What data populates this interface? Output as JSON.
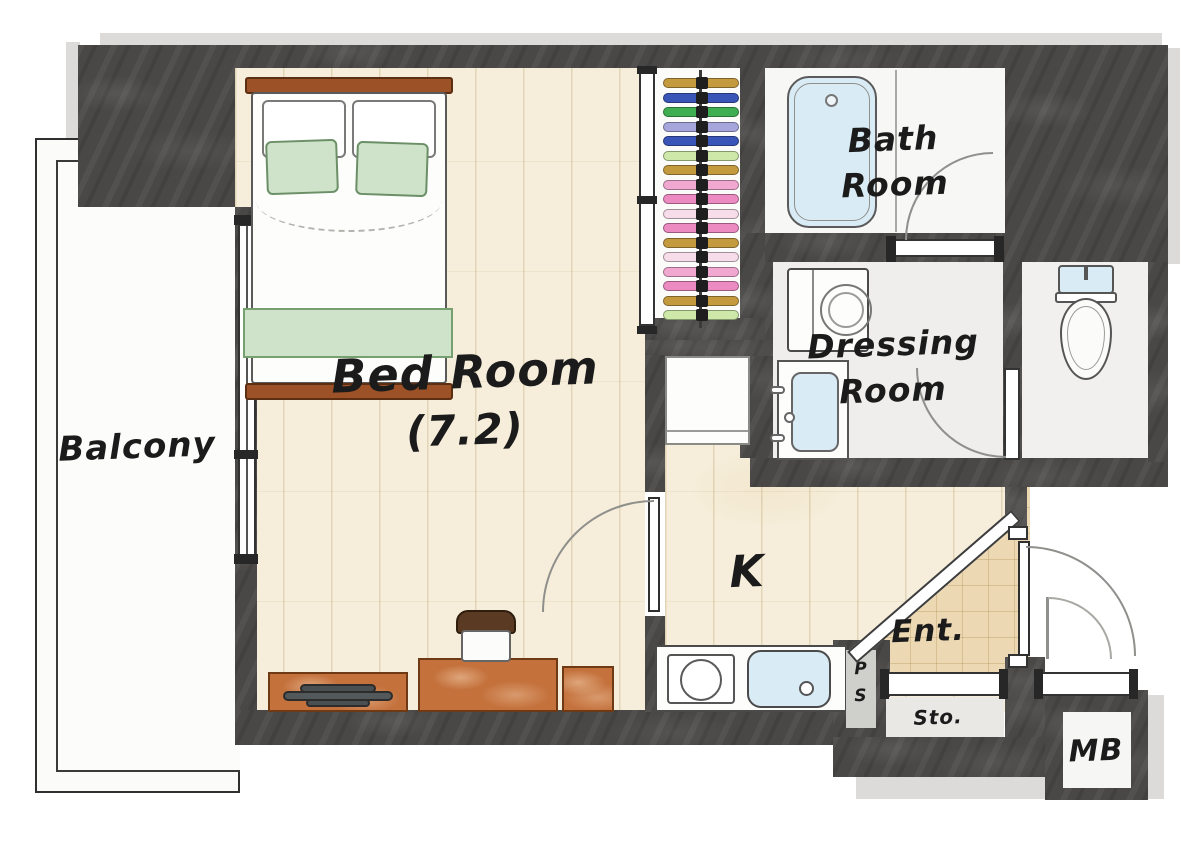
{
  "labels": {
    "balcony": "Balcony",
    "bedroom": "Bed Room",
    "bedroom_size": "(7.2)",
    "bath_line1": "Bath",
    "bath_line2": "Room",
    "dressing_line1": "Dressing",
    "dressing_line2": "Room",
    "kitchen": "K",
    "entrance": "Ent.",
    "storage": "Sto.",
    "pipe_shaft_p": "P",
    "pipe_shaft_s": "S",
    "meter_box": "MB"
  },
  "colors": {
    "wall": "#4a4846",
    "wood_floor": "#f6eedb",
    "tile_floor": "#efeeec",
    "entrance_floor": "#ecd9b4",
    "water_blue": "#d9ecf6",
    "furniture_wood": "#c4713c",
    "bed_green": "#cfe3ca",
    "headboard_brown": "#9c5126"
  },
  "closet": {
    "clothes_colors": [
      "#c49a3f",
      "#3a55b8",
      "#3fae52",
      "#a6a6dd",
      "#3a55b8",
      "#cde8a8",
      "#c49a3f",
      "#f0a8d0",
      "#ec8ac2",
      "#f7dcea",
      "#ec8ac2",
      "#c49a3f",
      "#f7dcea",
      "#f0a8d0",
      "#ec8ac2",
      "#c49a3f",
      "#cde8a8"
    ]
  }
}
